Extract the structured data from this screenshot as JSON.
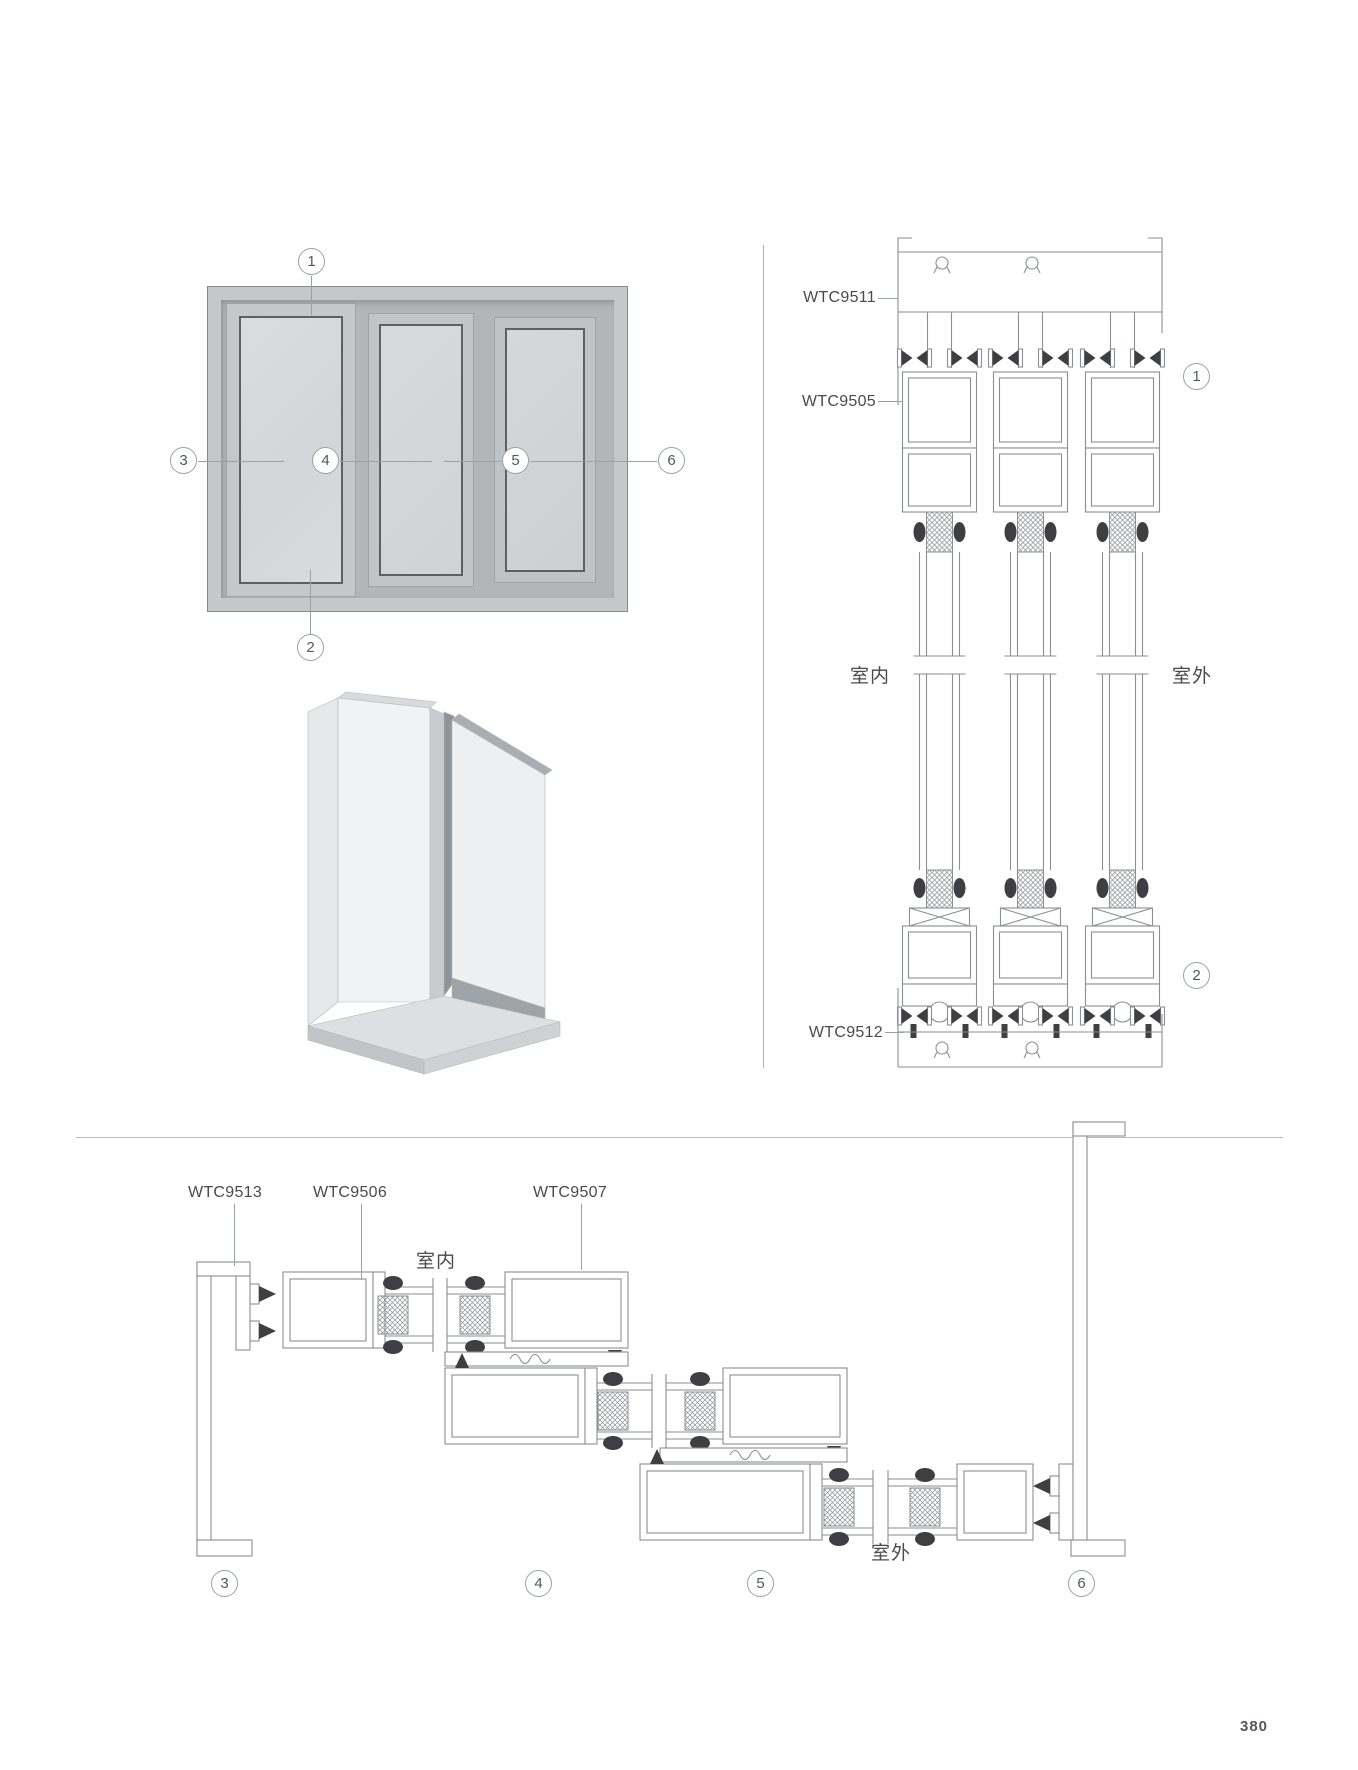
{
  "page": {
    "number": "380"
  },
  "colors": {
    "drawing_line": "#8b8e92",
    "seal_dark": "#3f3f43",
    "label_text": "#4a4a4e",
    "frame_gray": "#c5c8ca",
    "track_gray": "#b3b6b8",
    "glass_gray": "#d9dcde"
  },
  "elevation": {
    "description": "three-panel sliding window elevation",
    "callouts": [
      "1",
      "2",
      "3",
      "4",
      "5",
      "6"
    ]
  },
  "vertical_section": {
    "labels": [
      "WTC9511",
      "WTC9505",
      "WTC9512"
    ],
    "indoor": "室内",
    "outdoor": "室外",
    "callouts": [
      "1",
      "2"
    ]
  },
  "horizontal_section": {
    "labels": [
      "WTC9513",
      "WTC9506",
      "WTC9507"
    ],
    "indoor": "室内",
    "outdoor": "室外",
    "callouts": [
      "3",
      "4",
      "5",
      "6"
    ]
  }
}
